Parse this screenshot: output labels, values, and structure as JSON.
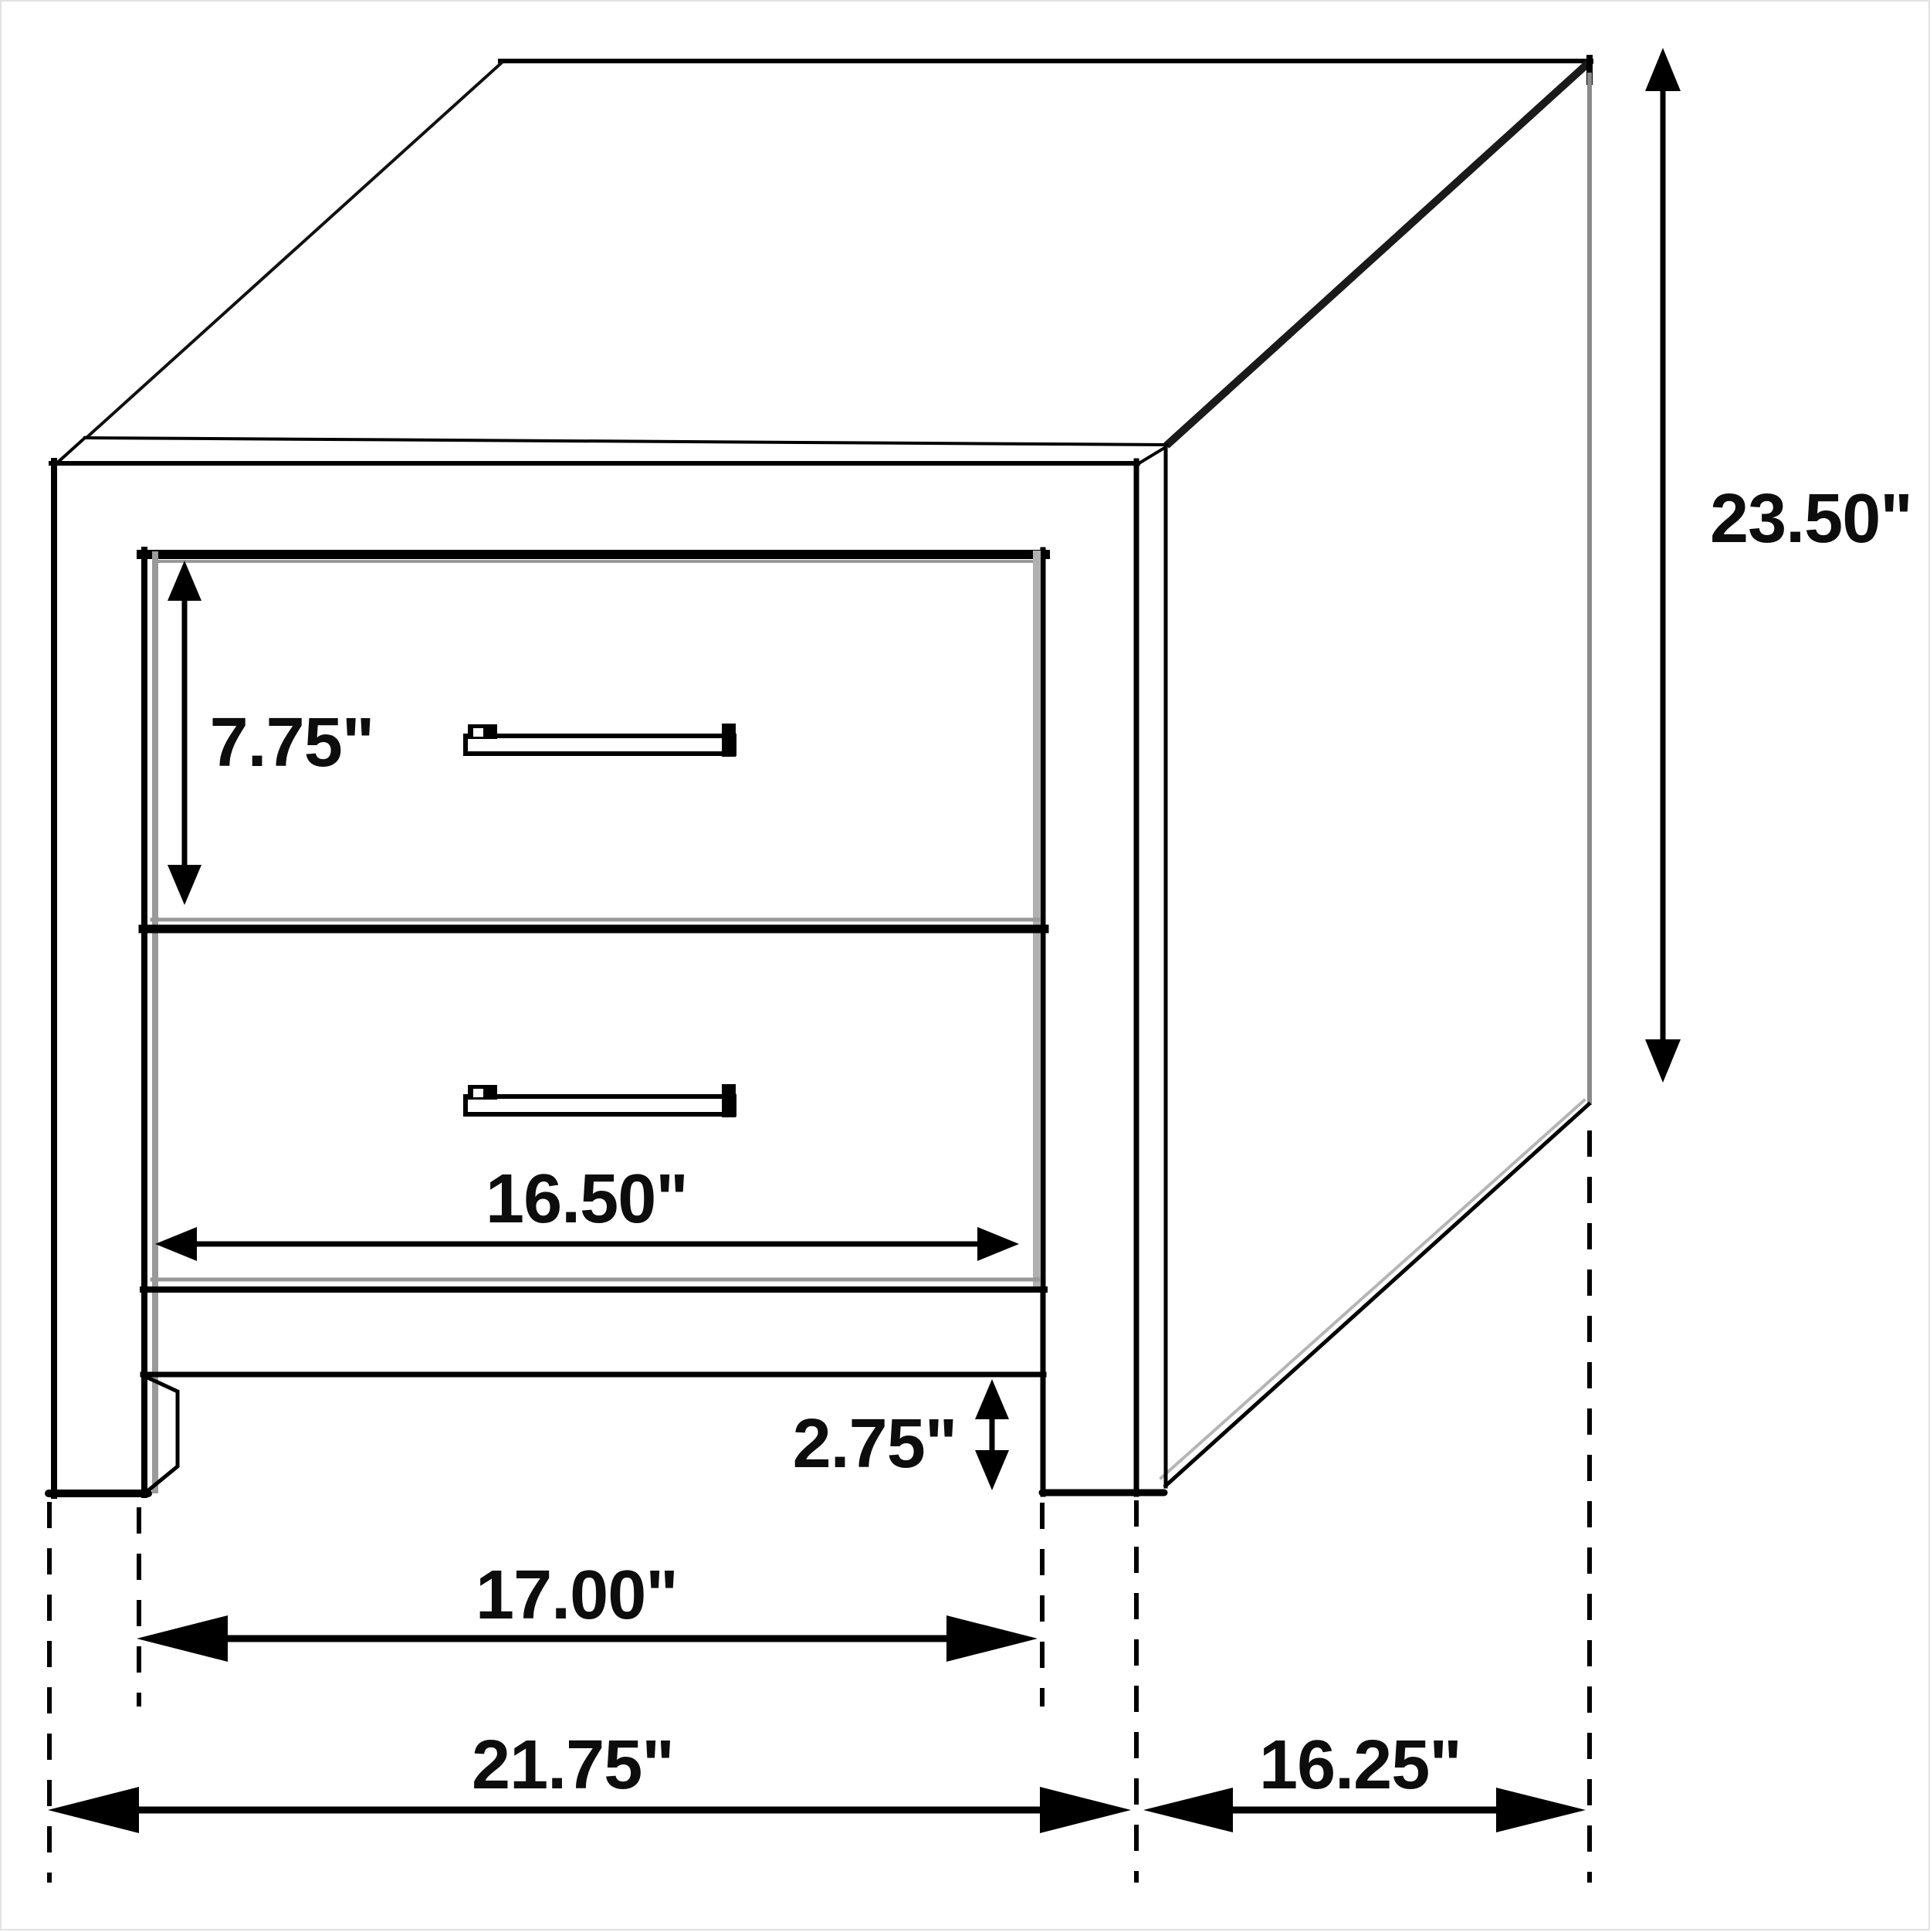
{
  "page": {
    "background": "#ffffff",
    "border_color": "#e2e2e2"
  },
  "diagram": {
    "subject": "Two-drawer nightstand isometric dimension drawing",
    "colors": {
      "line": "#000000",
      "shadow": "#999999",
      "panel_edge_gray": "#8a8a8a",
      "background": "#ffffff"
    },
    "dimensions": {
      "drawer_height": "7.75\"",
      "overall_height": "23.50\"",
      "drawer_width": "16.50\"",
      "foot_clearance": "2.75\"",
      "inner_width": "17.00\"",
      "overall_width": "21.75\"",
      "depth": "16.25\""
    }
  }
}
